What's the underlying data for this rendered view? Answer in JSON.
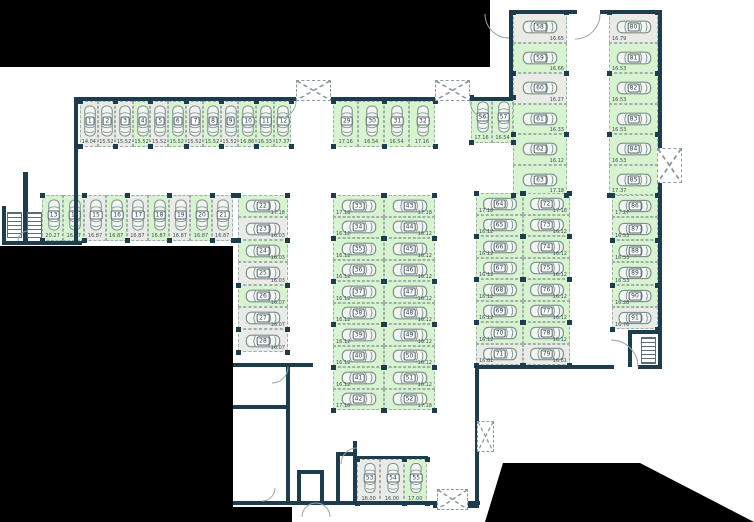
{
  "colors": {
    "wall": "#1d3c4d",
    "free_space": "#d8f3d0",
    "occupied_space": "#eaeae7",
    "outside_mask": "#000000",
    "car_outline": "#7d8f8c"
  },
  "icons": {
    "car": "car-top-view-icon",
    "gate": "crossed-dashed-box-icon",
    "stairs": "stairs-icon",
    "door": "door-swing-arc"
  },
  "blocks": [
    {
      "id": "top-left-row",
      "spaces": [
        {
          "no": "1",
          "area": "14.04",
          "state": "occupied"
        },
        {
          "no": "2",
          "area": "15.52",
          "state": "occupied"
        },
        {
          "no": "3",
          "area": "15.52",
          "state": "occupied"
        },
        {
          "no": "4",
          "area": "15.52",
          "state": "free"
        },
        {
          "no": "5",
          "area": "15.52",
          "state": "occupied"
        },
        {
          "no": "6",
          "area": "15.52",
          "state": "free"
        },
        {
          "no": "7",
          "area": "15.52",
          "state": "occupied"
        },
        {
          "no": "8",
          "area": "15.52",
          "state": "free"
        },
        {
          "no": "9",
          "area": "15.52",
          "state": "occupied"
        },
        {
          "no": "10",
          "area": "16.86",
          "state": "free"
        },
        {
          "no": "11",
          "area": "16.33",
          "state": "free"
        },
        {
          "no": "12",
          "area": "17.37",
          "state": "free"
        }
      ]
    },
    {
      "id": "second-left-row",
      "spaces": [
        {
          "no": "13",
          "area": "20.27",
          "state": "free"
        },
        {
          "no": "14",
          "area": "16.87",
          "state": "free"
        },
        {
          "no": "15",
          "area": "16.87",
          "state": "occupied"
        },
        {
          "no": "16",
          "area": "16.87",
          "state": "free"
        },
        {
          "no": "17",
          "area": "16.87",
          "state": "occupied"
        },
        {
          "no": "18",
          "area": "16.87",
          "state": "free"
        },
        {
          "no": "19",
          "area": "16.87",
          "state": "occupied"
        },
        {
          "no": "20",
          "area": "16.87",
          "state": "free"
        },
        {
          "no": "21",
          "area": "16.87",
          "state": "occupied"
        }
      ]
    },
    {
      "id": "left-column",
      "spaces": [
        {
          "no": "22",
          "area": "17.18",
          "state": "free"
        },
        {
          "no": "23",
          "area": "16.03",
          "state": "occupied"
        },
        {
          "no": "24",
          "area": "16.03",
          "state": "free"
        },
        {
          "no": "25",
          "area": "16.03",
          "state": "occupied"
        },
        {
          "no": "26",
          "area": "16.07",
          "state": "free"
        },
        {
          "no": "27",
          "area": "16.07",
          "state": "occupied"
        },
        {
          "no": "28",
          "area": "16.07",
          "state": "occupied"
        }
      ]
    },
    {
      "id": "top-middle-row",
      "spaces": [
        {
          "no": "29",
          "area": "17.16",
          "state": "free"
        },
        {
          "no": "30",
          "area": "16.54",
          "state": "free"
        },
        {
          "no": "31",
          "area": "16.54",
          "state": "free"
        },
        {
          "no": "32",
          "area": "17.16",
          "state": "free"
        }
      ]
    },
    {
      "id": "middle-column-left",
      "spaces": [
        {
          "no": "33",
          "area": "17.18",
          "state": "free"
        },
        {
          "no": "34",
          "area": "16.12",
          "state": "free"
        },
        {
          "no": "35",
          "area": "16.12",
          "state": "free"
        },
        {
          "no": "36",
          "area": "16.12",
          "state": "free"
        },
        {
          "no": "37",
          "area": "16.12",
          "state": "free"
        },
        {
          "no": "38",
          "area": "16.12",
          "state": "free"
        },
        {
          "no": "39",
          "area": "16.12",
          "state": "free"
        },
        {
          "no": "40",
          "area": "16.12",
          "state": "free"
        },
        {
          "no": "41",
          "area": "16.12",
          "state": "free"
        },
        {
          "no": "42",
          "area": "17.18",
          "state": "free"
        }
      ]
    },
    {
      "id": "middle-column-right",
      "spaces": [
        {
          "no": "43",
          "area": "17.18",
          "state": "free"
        },
        {
          "no": "44",
          "area": "16.12",
          "state": "free"
        },
        {
          "no": "45",
          "area": "16.12",
          "state": "free"
        },
        {
          "no": "46",
          "area": "16.12",
          "state": "free"
        },
        {
          "no": "47",
          "area": "16.12",
          "state": "free"
        },
        {
          "no": "48",
          "area": "16.12",
          "state": "free"
        },
        {
          "no": "49",
          "area": "16.12",
          "state": "free"
        },
        {
          "no": "50",
          "area": "16.12",
          "state": "free"
        },
        {
          "no": "51",
          "area": "16.12",
          "state": "free"
        },
        {
          "no": "52",
          "area": "17.18",
          "state": "free"
        }
      ]
    },
    {
      "id": "bottom-trio",
      "spaces": [
        {
          "no": "53",
          "area": "16.00",
          "state": "occupied"
        },
        {
          "no": "54",
          "area": "16.00",
          "state": "occupied"
        },
        {
          "no": "55",
          "area": "17.00",
          "state": "free"
        }
      ]
    },
    {
      "id": "upper-right-pair",
      "spaces": [
        {
          "no": "56",
          "area": "17.16",
          "state": "free"
        },
        {
          "no": "57",
          "area": "16.54",
          "state": "free"
        }
      ]
    },
    {
      "id": "upper-right-column-inner",
      "spaces": [
        {
          "no": "58",
          "area": "16.65",
          "state": "occupied"
        },
        {
          "no": "59",
          "area": "16.66",
          "state": "free"
        },
        {
          "no": "60",
          "area": "16.27",
          "state": "occupied"
        },
        {
          "no": "61",
          "area": "16.33",
          "state": "free"
        },
        {
          "no": "62",
          "area": "16.12",
          "state": "free"
        },
        {
          "no": "63",
          "area": "17.18",
          "state": "free"
        }
      ]
    },
    {
      "id": "right-block-left-column",
      "spaces": [
        {
          "no": "64",
          "area": "17.18",
          "state": "free"
        },
        {
          "no": "65",
          "area": "16.12",
          "state": "free"
        },
        {
          "no": "66",
          "area": "16.12",
          "state": "free"
        },
        {
          "no": "67",
          "area": "16.12",
          "state": "free"
        },
        {
          "no": "68",
          "area": "16.12",
          "state": "free"
        },
        {
          "no": "69",
          "area": "16.12",
          "state": "free"
        },
        {
          "no": "70",
          "area": "16.12",
          "state": "free"
        },
        {
          "no": "71",
          "area": "16.81",
          "state": "occupied"
        }
      ]
    },
    {
      "id": "right-block-right-column",
      "spaces": [
        {
          "no": "72",
          "area": "17.18",
          "state": "free"
        },
        {
          "no": "73",
          "area": "16.12",
          "state": "free"
        },
        {
          "no": "74",
          "area": "16.12",
          "state": "free"
        },
        {
          "no": "75",
          "area": "16.12",
          "state": "free"
        },
        {
          "no": "76",
          "area": "16.12",
          "state": "free"
        },
        {
          "no": "77",
          "area": "16.12",
          "state": "free"
        },
        {
          "no": "78",
          "area": "16.12",
          "state": "free"
        },
        {
          "no": "79",
          "area": "16.81",
          "state": "occupied"
        }
      ]
    },
    {
      "id": "far-right-column-upper",
      "spaces": [
        {
          "no": "80",
          "area": "16.79",
          "state": "occupied"
        },
        {
          "no": "81",
          "area": "16.53",
          "state": "free"
        },
        {
          "no": "82",
          "area": "16.53",
          "state": "free"
        },
        {
          "no": "83",
          "area": "16.53",
          "state": "free"
        },
        {
          "no": "84",
          "area": "16.53",
          "state": "free"
        },
        {
          "no": "85",
          "area": "17.37",
          "state": "free"
        }
      ]
    },
    {
      "id": "far-right-column-lower",
      "spaces": [
        {
          "no": "86",
          "area": "17.27",
          "state": "free"
        },
        {
          "no": "87",
          "area": "16.53",
          "state": "free"
        },
        {
          "no": "88",
          "area": "16.53",
          "state": "free"
        },
        {
          "no": "89",
          "area": "16.53",
          "state": "free"
        },
        {
          "no": "90",
          "area": "16.28",
          "state": "free"
        },
        {
          "no": "91",
          "area": "16.78",
          "state": "occupied"
        }
      ]
    }
  ]
}
